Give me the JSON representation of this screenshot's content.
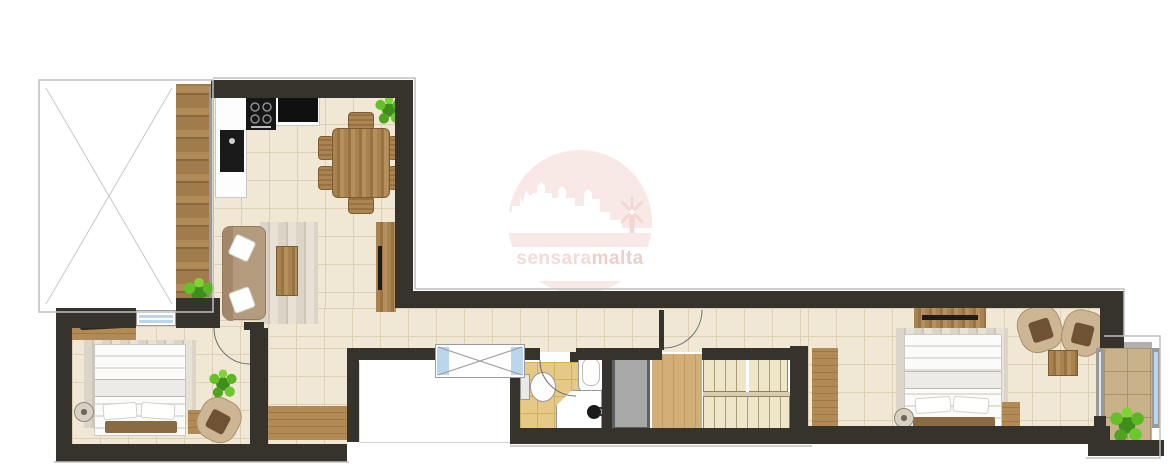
{
  "watermark": {
    "brand": "sensaramalta",
    "brand_left": "sensara",
    "brand_right": "malta"
  },
  "palette": {
    "wall": "#35332b",
    "floor_tile": "#f0e8d5",
    "floor_tile_line": "#ddd0b4",
    "bath_tile": "#e6c987",
    "bath_tile_line": "#d2b05f",
    "stone_tile": "#c8b28c",
    "stone_tile_line": "#ab9469",
    "deck_wood": "#a07c4c",
    "lift_gray": "#a8a8a8",
    "lift_border": "#5f5f5f",
    "glass_blue": "#b9d6ec",
    "bench_brown": "#8a6a42",
    "sofa_brown": "#b59b7d",
    "plant_green_light": "#6cc92d",
    "plant_green_dark": "#3f8d1c",
    "rug_light": "#dcd5c7",
    "watermark_circle": "#f8e8e6",
    "watermark_motif": "#f2d8d5",
    "watermark_text_left": "#f3dbd7",
    "watermark_text_right": "#eccfca",
    "outline_gray": "#bfbfbf",
    "door_arc": "#6b6b6b"
  }
}
